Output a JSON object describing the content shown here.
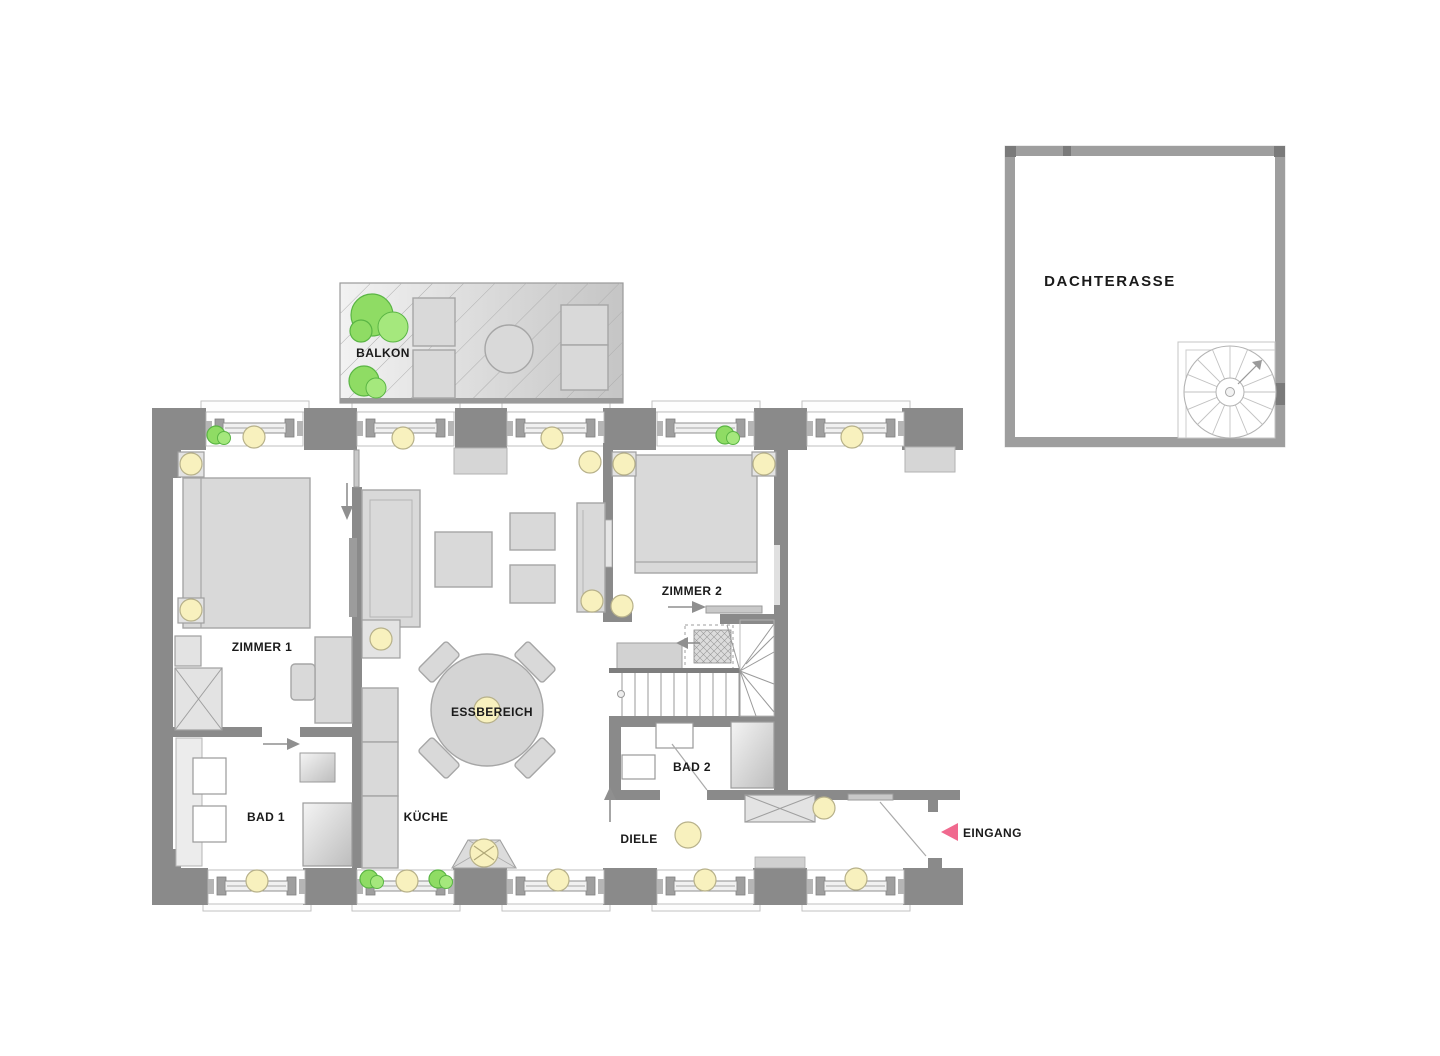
{
  "labels": {
    "balkon": "BALKON",
    "zimmer1": "ZIMMER 1",
    "zimmer2": "ZIMMER 2",
    "essbereich": "ESSBEREICH",
    "kueche": "KÜCHE",
    "bad1": "BAD 1",
    "bad2": "BAD 2",
    "diele": "DIELE",
    "eingang": "EINGANG",
    "dachterasse": "DACHTERASSE"
  },
  "colors": {
    "wall": "#8a8a8a",
    "roofWall": "#9e9e9e",
    "roofWallDark": "#7a7a7a",
    "furn": "#d9d9d9",
    "furnBorder": "#a6a6a6",
    "lamp": "#f8f1be",
    "lampBorder": "#b7b18a",
    "plant": "#8fdc64",
    "plantDark": "#5ab544",
    "arrowPink": "#f0698e",
    "text": "#1a1a1a",
    "balconyLight": "#f2f2f2",
    "balconyDark": "#c5c5c5"
  }
}
